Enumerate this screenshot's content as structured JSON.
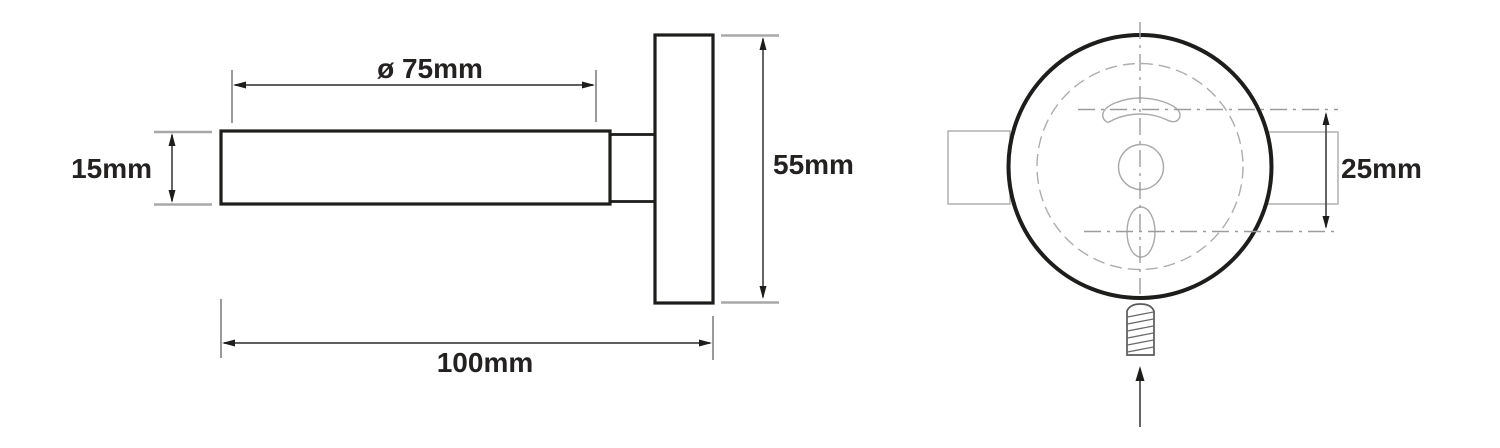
{
  "diagram": {
    "kind": "technical-dimension-drawing",
    "colors": {
      "background": "#ffffff",
      "part_outline": "#1d1d1b",
      "dimension_line": "#4a4a4a",
      "extension_line": "#a8a8a8",
      "construction_line": "#adadad",
      "label_text": "#242121"
    },
    "side_view": {
      "parts": [
        "wall-rod",
        "rod-neck",
        "mounting-plate"
      ],
      "dimensions": {
        "rod_length": {
          "label": "ø 75mm",
          "value_mm": 75
        },
        "rod_diameter": {
          "label": "15mm",
          "value_mm": 15
        },
        "plate_diameter": {
          "label": "55mm",
          "value_mm": 55
        },
        "total_depth": {
          "label": "100mm",
          "value_mm": 100
        }
      }
    },
    "front_view": {
      "parts": [
        "mounting-plate-face",
        "keyhole-slot",
        "center-hole",
        "screw-hole",
        "mounting-screw",
        "insert-direction-arrow"
      ],
      "dimensions": {
        "hole_spacing": {
          "label": "25mm",
          "value_mm": 25
        }
      }
    }
  }
}
